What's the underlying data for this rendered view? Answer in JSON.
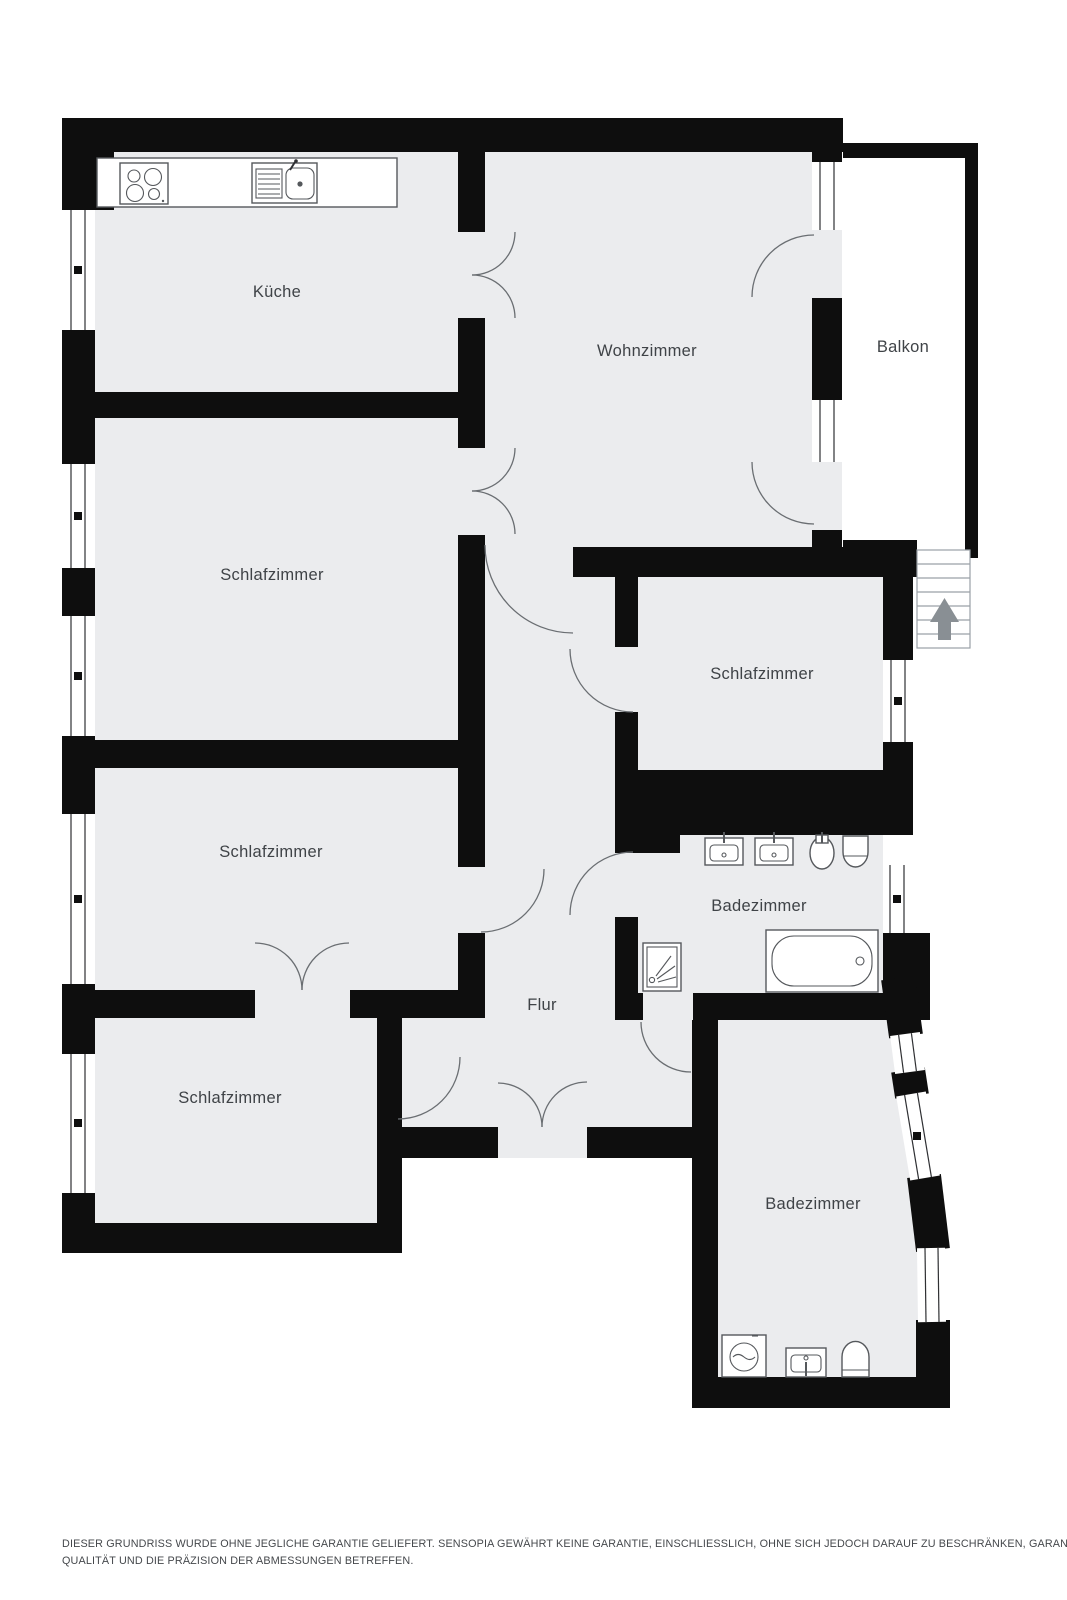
{
  "rooms": [
    {
      "id": "kueche",
      "label": "Küche"
    },
    {
      "id": "wohnzimmer",
      "label": "Wohnzimmer"
    },
    {
      "id": "balkon",
      "label": "Balkon"
    },
    {
      "id": "schlafzimmer-oben-links",
      "label": "Schlafzimmer"
    },
    {
      "id": "schlafzimmer-rechts",
      "label": "Schlafzimmer"
    },
    {
      "id": "schlafzimmer-mitte-links",
      "label": "Schlafzimmer"
    },
    {
      "id": "badezimmer-mitte",
      "label": "Badezimmer"
    },
    {
      "id": "flur",
      "label": "Flur"
    },
    {
      "id": "schlafzimmer-unten-links",
      "label": "Schlafzimmer"
    },
    {
      "id": "badezimmer-unten",
      "label": "Badezimmer"
    }
  ],
  "stairs": {
    "steps": 7,
    "direction": "up"
  },
  "fixtures": [
    "stove",
    "kitchen-sink",
    "bathroom-sink",
    "bathroom-sink",
    "bidet",
    "toilet",
    "shower",
    "bathtub",
    "washing-machine",
    "bathroom-sink",
    "toilet"
  ],
  "colors": {
    "wall": "#0e0e0e",
    "floor": "#ebecee",
    "outside": "#ffffff",
    "room_label": "#3f4347",
    "door_arc": "#6a6e72",
    "window_line": "#2f3033",
    "stairs_arrow": "#898f94",
    "fixture_line": "#55585c"
  },
  "disclaimer": {
    "line1": "DIESER GRUNDRISS WURDE OHNE JEGLICHE GARANTIE GELIEFERT. SENSOPIA GEWÄHRT KEINE GARANTIE, EINSCHLIESSLICH, OHNE SICH JEDOCH DARAUF ZU BESCHRÄNKEN, GARANTIEN, DIE DIE",
    "line2": "QUALITÄT UND DIE PRÄZISION DER ABMESSUNGEN BETREFFEN."
  }
}
